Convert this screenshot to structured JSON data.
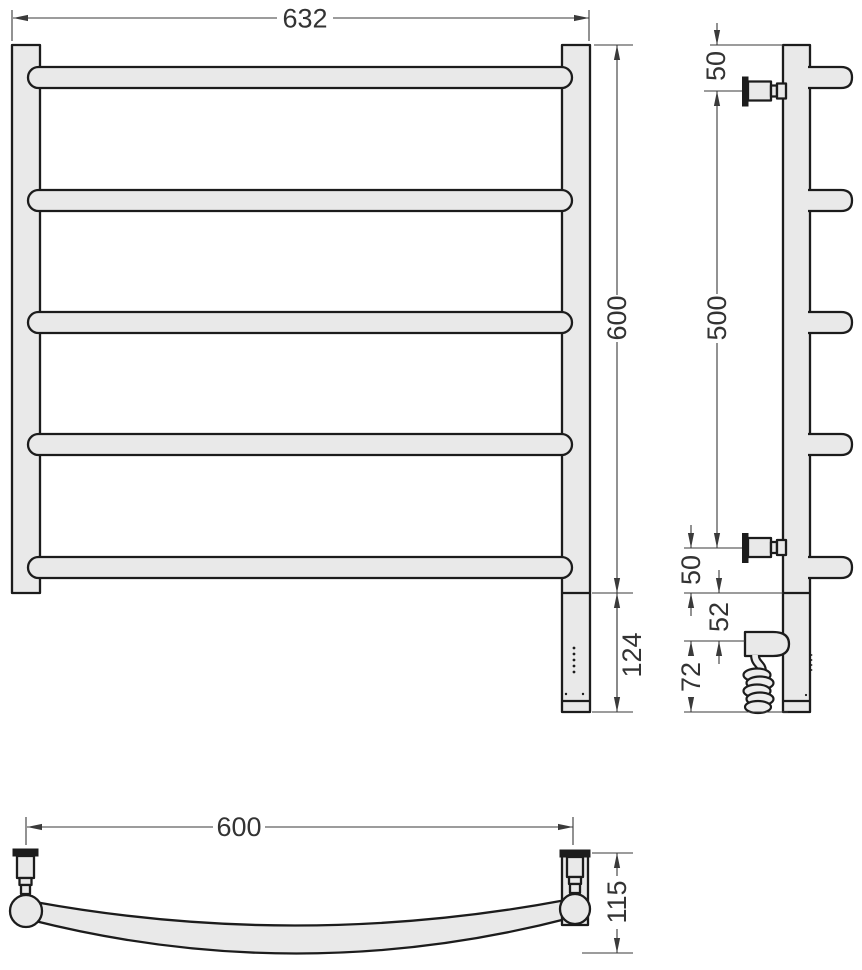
{
  "drawing": {
    "kind": "technical-dimension-drawing",
    "colors": {
      "part_fill": "#e9e9e9",
      "part_stroke": "#1c1c1c",
      "dimension_stroke": "#3a3a3a",
      "label_color": "#333333",
      "background": "#ffffff"
    }
  },
  "dims": {
    "front": {
      "overall_width": "632",
      "rail_height": "600",
      "heater_section": "124"
    },
    "side": {
      "top_to_bracket": "50",
      "bracket_spacing": "500",
      "bracket_to_base": "50",
      "base_to_heater": "52",
      "heater_to_bottom": "72"
    },
    "bottom": {
      "bracket_spacing": "600",
      "curve_depth": "115"
    }
  }
}
